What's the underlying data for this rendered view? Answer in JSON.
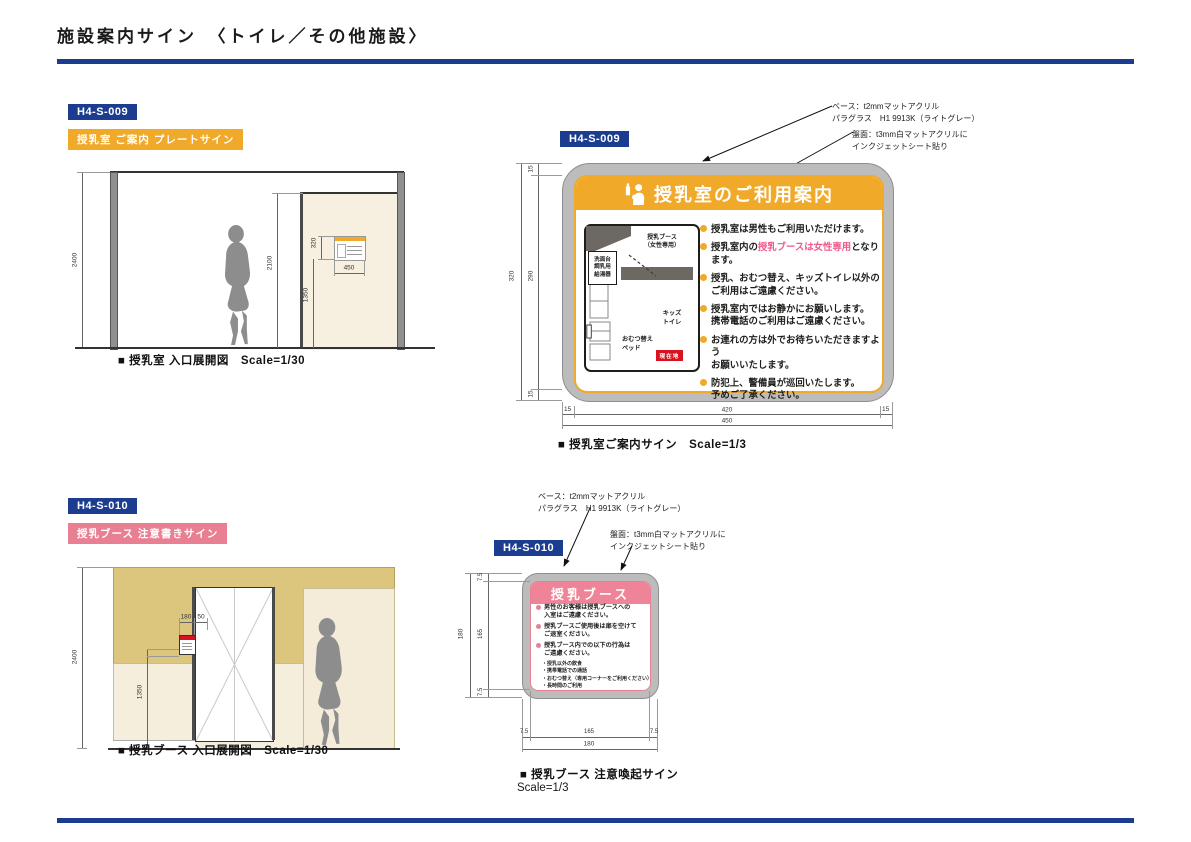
{
  "colors": {
    "navy": "#1c3d8f",
    "orange": "#f0a929",
    "pink": "#e87f92",
    "pinkheader": "#ef8498",
    "hlpink": "#f0598c",
    "red": "#d9121f",
    "panelgrey": "#bcbcbc",
    "tan": "#dcc67d",
    "cream": "#f6eedd",
    "doorcream": "#f7f0e1",
    "silhouette": "#8d8d8d"
  },
  "page": {
    "title": "施設案内サイン　〈トイレ／その他施設〉"
  },
  "s1": {
    "code": "H4-S-009",
    "tag": "授乳室 ご案内 プレートサイン",
    "elev": {
      "caption": "■ 授乳室 入口展開図　Scale=1/30",
      "d2400": "2400",
      "d2100": "2100",
      "d1350": "1350",
      "d320": "320",
      "d450": "450"
    },
    "sign": {
      "code": "H4-S-009",
      "note1": "ベース：t2mmマットアクリル\nパラグラス　H1 9913K（ライトグレー）",
      "note2": "盤面：t3mm白マットアクリルに\nインクジェットシート貼り",
      "title": "授乳室のご利用案内",
      "map": {
        "booth": "授乳ブース\n（女性専用）",
        "sink": "洗面台\n調乳用\n給湯器",
        "kids": "キッズ\nトイレ",
        "diaper": "おむつ替え\nベッド",
        "here": "現在地"
      },
      "bullets": [
        {
          "text": "授乳室は男性もご利用いただけます。"
        },
        {
          "pre": "授乳室内の",
          "hl": "授乳ブースは女性専用",
          "post": "となります。"
        },
        {
          "text": "授乳、おむつ替え、キッズトイレ以外の\nご利用はご遠慮ください。"
        },
        {
          "text": "授乳室内ではお静かにお願いします。\n携帯電話のご利用はご遠慮ください。"
        },
        {
          "text": "お連れの方は外でお待ちいただきますよう\nお願いいたします。"
        },
        {
          "text": "防犯上、警備員が巡回いたします。\n予めご了承ください。"
        }
      ],
      "dims": {
        "t15": "15",
        "m290": "290",
        "b15": "15",
        "totalh": "320",
        "l15": "15",
        "m420": "420",
        "r15": "15",
        "totalw": "450"
      },
      "caption": "■ 授乳室ご案内サイン　Scale=1/3"
    }
  },
  "s2": {
    "code": "H4-S-010",
    "tag": "授乳ブース 注意書きサイン",
    "elev": {
      "caption": "■ 授乳ブース 入口展開図　Scale=1/30",
      "d2400": "2400",
      "d1350": "1350",
      "d180": "180",
      "d50": "50"
    },
    "sign": {
      "code": "H4-S-010",
      "note1": "ベース：t2mmマットアクリル\nパラグラス　H1 9913K（ライトグレー）",
      "note2": "盤面：t3mm白マットアクリルに\nインクジェットシート貼り",
      "title": "授乳ブース",
      "bullets": [
        {
          "text": "男性のお客様は授乳ブースへの\n入室はご遠慮ください。"
        },
        {
          "text": "授乳ブースご使用後は扉を空けて\nご退室ください。"
        },
        {
          "text": "授乳ブース内での以下の行為は\nご遠慮ください。"
        }
      ],
      "subs": [
        "・授乳以外の飲食",
        "・携帯電話での通話",
        "・おむつ替え（専用コーナーをご利用ください）",
        "・長時間のご利用"
      ],
      "dims": {
        "t75": "7.5",
        "m165": "165",
        "b75": "7.5",
        "totalh": "180",
        "l75": "7.5",
        "bm165": "165",
        "r75": "7.5",
        "totalw": "180"
      },
      "caption1": "■ 授乳ブース 注意喚起サイン",
      "caption2": "Scale=1/3"
    }
  }
}
